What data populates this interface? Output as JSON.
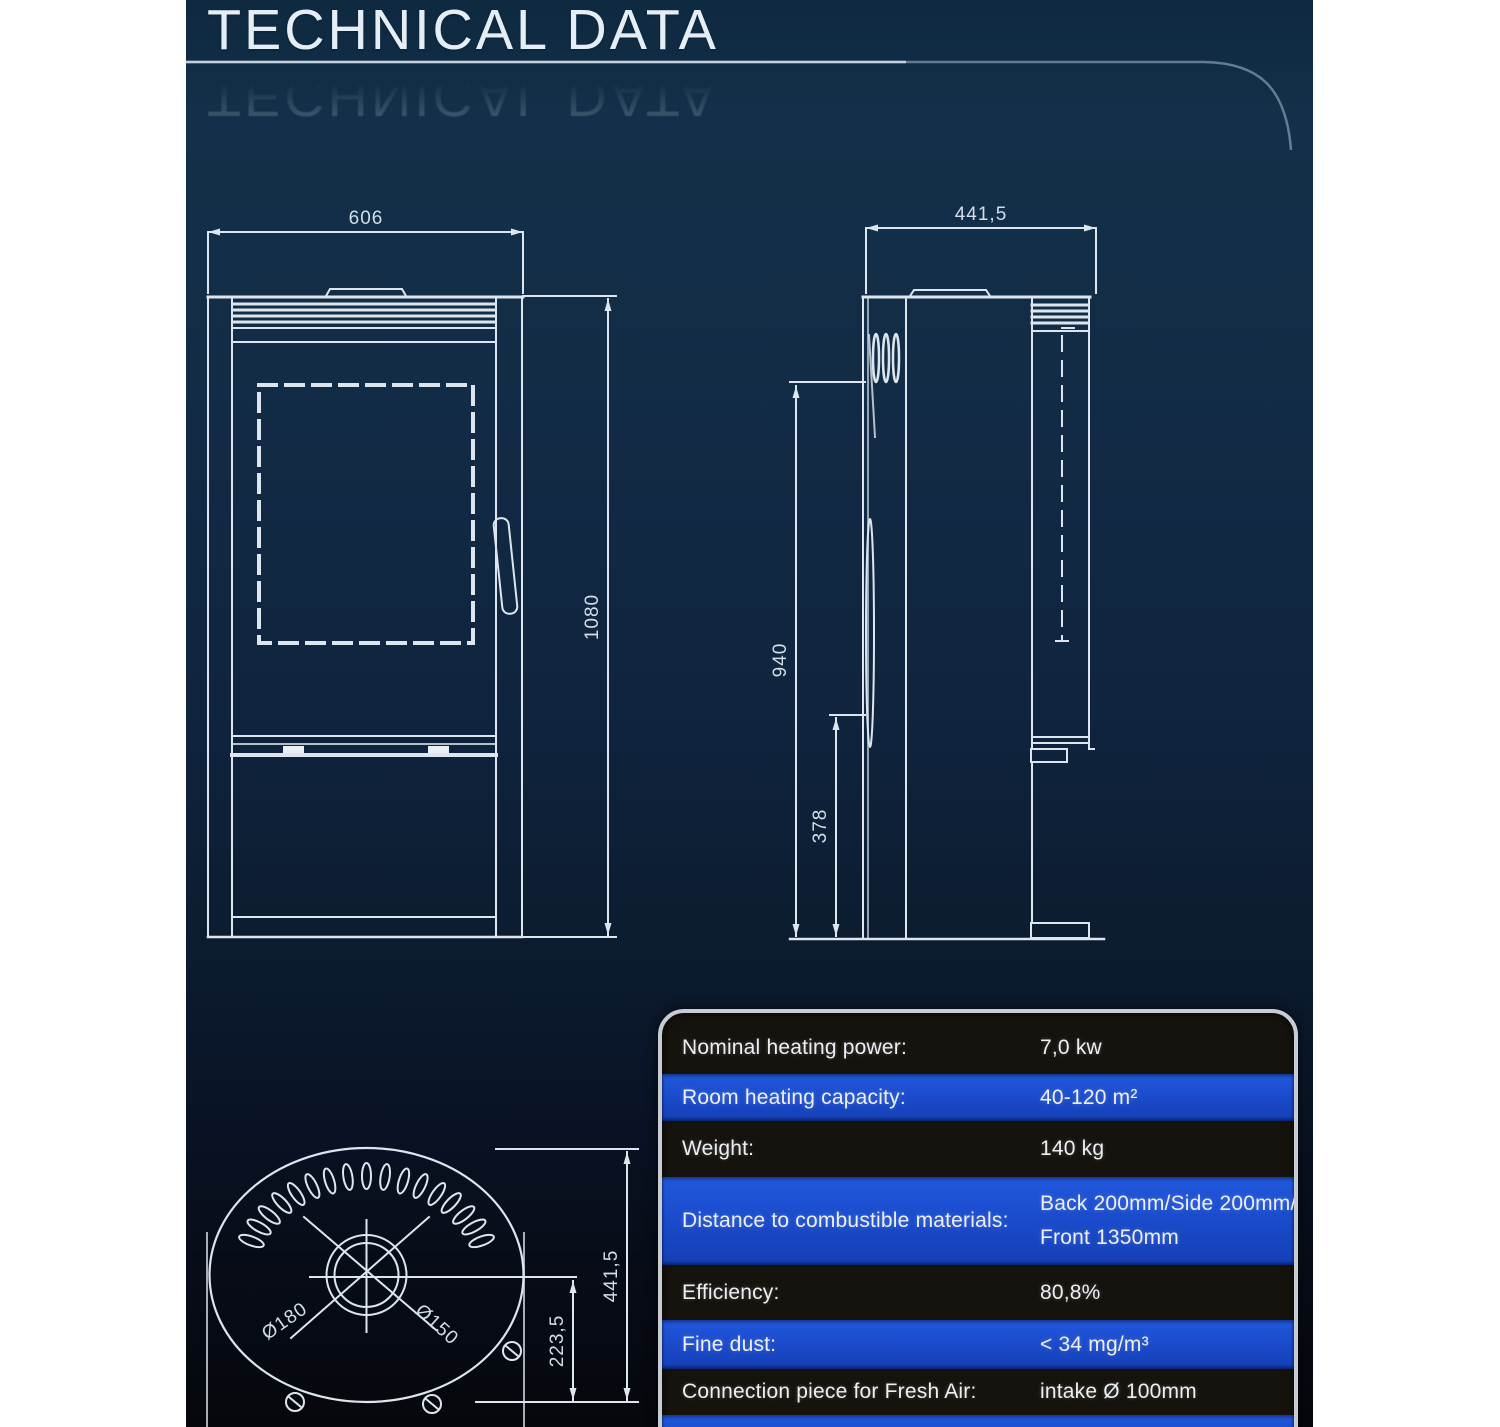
{
  "page": {
    "title": "TECHNICAL DATA"
  },
  "drawings": {
    "front_view": {
      "width_mm": "606",
      "height_mm": "1080"
    },
    "side_view": {
      "depth_mm": "441,5",
      "upper_height_mm": "940",
      "lower_height_mm": "378"
    },
    "top_view": {
      "depth_mm": "441,5",
      "flue_center_offset_mm": "223,5",
      "flue_outer_diameter": "Ø180",
      "flue_inner_diameter": "Ø150"
    }
  },
  "spec_table": {
    "rows": [
      {
        "label": "Nominal heating power:",
        "value": "7,0 kw",
        "value2": "",
        "variant": "dark"
      },
      {
        "label": "Room heating capacity:",
        "value": "40-120 m²",
        "value2": "",
        "variant": "blue"
      },
      {
        "label": "Weight:",
        "value": "140 kg",
        "value2": "",
        "variant": "dark"
      },
      {
        "label": "Distance to combustible materials:",
        "value": "Back 200mm/Side 200mm/",
        "value2": "Front 1350mm",
        "variant": "blue"
      },
      {
        "label": "Efficiency:",
        "value": "80,8%",
        "value2": "",
        "variant": "dark"
      },
      {
        "label": "Fine dust:",
        "value": "< 34 mg/m³",
        "value2": "",
        "variant": "blue"
      },
      {
        "label": "Connection piece for Fresh Air:",
        "value": "intake Ø 100mm",
        "value2": "",
        "variant": "dark"
      },
      {
        "label": "",
        "value": "",
        "value2": "",
        "variant": "blue"
      }
    ]
  },
  "colors": {
    "accent_blue": "#1b4ccd",
    "row_dark": "#16120d",
    "drawing_line": "#dde6ee",
    "background_top": "#0e2940",
    "background_bottom": "#06070c"
  }
}
